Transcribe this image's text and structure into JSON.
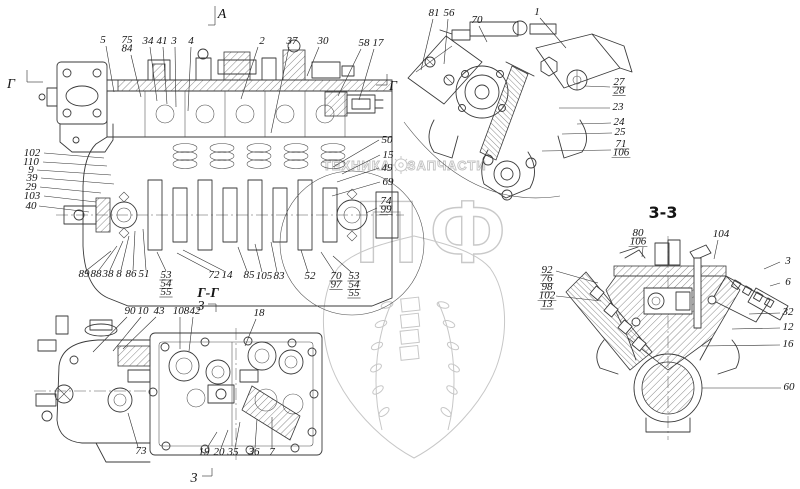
{
  "watermark": {
    "left_text": "ТЕХНИКА",
    "right_text": "ЗАПЧАСТИ",
    "big_text": "ПФ"
  },
  "markers": [
    {
      "t": "A",
      "x": 222,
      "y": 18,
      "cls": "marker",
      "lines": [
        [
          215,
          6,
          215,
          25
        ],
        [
          208,
          25,
          215,
          25
        ]
      ]
    },
    {
      "t": "Г",
      "x": 11,
      "y": 88,
      "cls": "marker",
      "lines": [
        [
          27,
          70,
          27,
          82
        ],
        [
          27,
          82,
          43,
          82
        ]
      ]
    },
    {
      "t": "Г",
      "x": 393,
      "y": 90,
      "cls": "marker",
      "lines": [
        [
          376,
          85,
          387,
          85
        ],
        [
          387,
          74,
          387,
          85
        ]
      ]
    },
    {
      "t": "Г-Г",
      "x": 208,
      "y": 297,
      "cls": "title",
      "lines": []
    },
    {
      "t": "3",
      "x": 201,
      "y": 310,
      "cls": "marker",
      "lines": [
        [
          208,
          304,
          216,
          304
        ],
        [
          216,
          304,
          216,
          312
        ]
      ]
    },
    {
      "t": "3",
      "x": 194,
      "y": 482,
      "cls": "marker",
      "lines": [
        [
          202,
          476,
          212,
          476
        ],
        [
          212,
          468,
          212,
          476
        ]
      ]
    },
    {
      "t": "3-3",
      "x": 663,
      "y": 218,
      "cls": "title2",
      "lines": []
    }
  ],
  "views": [
    {
      "name": "main-longitudinal-section",
      "callouts": [
        {
          "t": [
            "5"
          ],
          "x": 103,
          "y": 43,
          "l": [
            [
              106,
              46,
              114,
              92
            ]
          ]
        },
        {
          "t": [
            "75",
            "84"
          ],
          "x": 127,
          "y": 43,
          "l": [
            [
              131,
              55,
              141,
              97
            ]
          ]
        },
        {
          "t": [
            "34"
          ],
          "x": 148,
          "y": 44,
          "l": [
            [
              150,
              47,
              157,
              101
            ]
          ]
        },
        {
          "t": [
            "41"
          ],
          "x": 162,
          "y": 44,
          "l": [
            [
              163,
              47,
              167,
              104
            ]
          ]
        },
        {
          "t": [
            "3"
          ],
          "x": 174,
          "y": 44,
          "l": [
            [
              175,
              47,
              176,
              107
            ]
          ]
        },
        {
          "t": [
            "4"
          ],
          "x": 191,
          "y": 44,
          "l": [
            [
              191,
              47,
              188,
              111
            ]
          ]
        },
        {
          "t": [
            "2"
          ],
          "x": 262,
          "y": 44,
          "l": [
            [
              258,
              47,
              241,
              99
            ]
          ]
        },
        {
          "t": [
            "37"
          ],
          "x": 292,
          "y": 44,
          "l": [
            [
              289,
              47,
              271,
              133
            ]
          ]
        },
        {
          "t": [
            "30"
          ],
          "x": 323,
          "y": 44,
          "l": [
            [
              319,
              47,
              307,
              76
            ]
          ]
        },
        {
          "t": [
            "58"
          ],
          "x": 364,
          "y": 46,
          "l": [
            [
              361,
              49,
              338,
              96
            ]
          ]
        },
        {
          "t": [
            "17"
          ],
          "x": 378,
          "y": 46,
          "l": [
            [
              374,
              49,
              359,
              100
            ]
          ]
        },
        {
          "t": [
            "102"
          ],
          "x": 32,
          "y": 156,
          "l": [
            [
              44,
              153,
              104,
              158
            ]
          ]
        },
        {
          "t": [
            "110"
          ],
          "x": 31,
          "y": 165,
          "l": [
            [
              43,
              162,
              107,
              166
            ]
          ]
        },
        {
          "t": [
            "9"
          ],
          "x": 31,
          "y": 173,
          "l": [
            [
              37,
              170,
              111,
              175
            ]
          ]
        },
        {
          "t": [
            "39"
          ],
          "x": 32,
          "y": 181,
          "l": [
            [
              41,
              178,
              114,
              184
            ]
          ]
        },
        {
          "t": [
            "29"
          ],
          "x": 31,
          "y": 190,
          "l": [
            [
              40,
              187,
              101,
              193
            ]
          ]
        },
        {
          "t": [
            "103"
          ],
          "x": 32,
          "y": 199,
          "l": [
            [
              44,
              196,
              96,
              202
            ]
          ]
        },
        {
          "t": [
            "40"
          ],
          "x": 31,
          "y": 209,
          "l": [
            [
              39,
              206,
              89,
              212
            ]
          ]
        },
        {
          "t": [
            "50"
          ],
          "x": 387,
          "y": 143,
          "l": [
            [
              379,
              140,
              333,
              167
            ]
          ]
        },
        {
          "t": [
            "15"
          ],
          "x": 388,
          "y": 158,
          "l": [
            [
              380,
              155,
              342,
              174
            ]
          ]
        },
        {
          "t": [
            "49"
          ],
          "x": 387,
          "y": 171,
          "l": [
            [
              379,
              168,
              337,
              182
            ]
          ]
        },
        {
          "t": [
            "69"
          ],
          "x": 388,
          "y": 185,
          "l": [
            [
              380,
              182,
              332,
              196
            ]
          ]
        },
        {
          "t": [
            "74",
            "99"
          ],
          "x": 386,
          "y": 204,
          "u": 1,
          "l": [
            [
              377,
              208,
              366,
              213
            ]
          ]
        },
        {
          "t": [
            "89"
          ],
          "x": 84,
          "y": 277,
          "l": [
            [
              87,
              270,
              111,
              251
            ]
          ]
        },
        {
          "t": [
            "88"
          ],
          "x": 96,
          "y": 277,
          "l": [
            [
              99,
              270,
              117,
              246
            ]
          ]
        },
        {
          "t": [
            "38"
          ],
          "x": 108,
          "y": 277,
          "l": [
            [
              110,
              270,
              123,
              241
            ]
          ]
        },
        {
          "t": [
            "8"
          ],
          "x": 119,
          "y": 277,
          "l": [
            [
              121,
              270,
              129,
              236
            ]
          ]
        },
        {
          "t": [
            "86"
          ],
          "x": 131,
          "y": 277,
          "l": [
            [
              133,
              270,
              135,
              231
            ]
          ]
        },
        {
          "t": [
            "51"
          ],
          "x": 144,
          "y": 277,
          "l": [
            [
              146,
              270,
              143,
              229
            ]
          ]
        },
        {
          "t": [
            "53",
            "54",
            "55"
          ],
          "x": 166,
          "y": 278,
          "u": 1,
          "l": [
            [
              166,
              271,
              157,
              252
            ]
          ]
        },
        {
          "t": [
            "72"
          ],
          "x": 214,
          "y": 278,
          "l": [
            [
              211,
              271,
              177,
              253
            ]
          ]
        },
        {
          "t": [
            "14"
          ],
          "x": 227,
          "y": 278,
          "l": [
            [
              224,
              271,
              183,
              250
            ]
          ]
        },
        {
          "t": [
            "85"
          ],
          "x": 249,
          "y": 278,
          "l": [
            [
              247,
              271,
              238,
              247
            ]
          ]
        },
        {
          "t": [
            "105"
          ],
          "x": 264,
          "y": 279,
          "l": [
            [
              262,
              272,
              255,
              244
            ]
          ]
        },
        {
          "t": [
            "83"
          ],
          "x": 279,
          "y": 279,
          "l": [
            [
              277,
              272,
              271,
              242
            ]
          ]
        },
        {
          "t": [
            "52"
          ],
          "x": 310,
          "y": 279,
          "l": [
            [
              308,
              272,
              301,
              250
            ]
          ]
        },
        {
          "t": [
            "70",
            "97"
          ],
          "x": 336,
          "y": 279,
          "u": 1,
          "l": [
            [
              334,
              272,
              321,
              252
            ]
          ]
        },
        {
          "t": [
            "53",
            "54",
            "55"
          ],
          "x": 354,
          "y": 279,
          "u": 1,
          "l": [
            [
              351,
              272,
              333,
              256
            ]
          ]
        }
      ]
    },
    {
      "name": "front-view",
      "callouts": [
        {
          "t": [
            "81"
          ],
          "x": 434,
          "y": 16,
          "l": [
            [
              433,
              19,
              421,
              70
            ]
          ]
        },
        {
          "t": [
            "56"
          ],
          "x": 449,
          "y": 16,
          "l": [
            [
              448,
              19,
              444,
              64
            ]
          ]
        },
        {
          "t": [
            "70"
          ],
          "x": 477,
          "y": 23,
          "l": [
            [
              479,
              26,
              487,
              42
            ]
          ]
        },
        {
          "t": [
            "1"
          ],
          "x": 537,
          "y": 15,
          "l": [
            [
              540,
              18,
              566,
              48
            ]
          ]
        },
        {
          "t": [
            "27",
            "28"
          ],
          "x": 619,
          "y": 85,
          "u": 1,
          "l": [
            [
              610,
              87,
              585,
              86
            ]
          ]
        },
        {
          "t": [
            "23"
          ],
          "x": 618,
          "y": 110,
          "l": [
            [
              610,
              108,
              559,
              108
            ]
          ]
        },
        {
          "t": [
            "24"
          ],
          "x": 619,
          "y": 125,
          "l": [
            [
              611,
              123,
              577,
              124
            ]
          ]
        },
        {
          "t": [
            "25"
          ],
          "x": 620,
          "y": 135,
          "l": [
            [
              612,
              133,
              562,
              134
            ]
          ]
        },
        {
          "t": [
            "71",
            "106"
          ],
          "x": 621,
          "y": 147,
          "u": 1,
          "l": [
            [
              611,
              150,
              542,
              151
            ]
          ]
        }
      ]
    },
    {
      "name": "section-g-g",
      "callouts": [
        {
          "t": [
            "90"
          ],
          "x": 130,
          "y": 314,
          "l": [
            [
              127,
              317,
              93,
              352
            ]
          ]
        },
        {
          "t": [
            "10"
          ],
          "x": 143,
          "y": 314,
          "l": [
            [
              141,
              317,
              113,
              351
            ]
          ]
        },
        {
          "t": [
            "43"
          ],
          "x": 159,
          "y": 314,
          "l": [
            [
              156,
              317,
              123,
              349
            ]
          ]
        },
        {
          "t": [
            "108"
          ],
          "x": 181,
          "y": 314,
          "l": [
            [
              180,
              317,
              180,
              349
            ]
          ]
        },
        {
          "t": [
            "42"
          ],
          "x": 195,
          "y": 314,
          "l": [
            [
              193,
              317,
              189,
              351
            ]
          ]
        },
        {
          "t": [
            "18"
          ],
          "x": 259,
          "y": 316,
          "l": [
            [
              256,
              319,
              245,
              346
            ]
          ]
        },
        {
          "t": [
            "73"
          ],
          "x": 141,
          "y": 454,
          "l": [
            [
              138,
              447,
              128,
              413
            ]
          ]
        },
        {
          "t": [
            "19"
          ],
          "x": 204,
          "y": 455,
          "l": [
            [
              207,
              448,
              217,
              432
            ]
          ]
        },
        {
          "t": [
            "20"
          ],
          "x": 219,
          "y": 455,
          "l": [
            [
              221,
              448,
              228,
              430
            ]
          ]
        },
        {
          "t": [
            "35"
          ],
          "x": 233,
          "y": 455,
          "l": [
            [
              235,
              448,
              240,
              422
            ]
          ]
        },
        {
          "t": [
            "36"
          ],
          "x": 254,
          "y": 455,
          "l": [
            [
              255,
              448,
              257,
              419
            ]
          ]
        },
        {
          "t": [
            "7"
          ],
          "x": 272,
          "y": 455,
          "l": [
            [
              272,
              448,
              272,
              417
            ]
          ]
        }
      ]
    },
    {
      "name": "section-3-3",
      "callouts": [
        {
          "t": [
            "80",
            "106"
          ],
          "x": 638,
          "y": 236,
          "u": 1,
          "l": [
            [
              643,
              247,
              642,
              257
            ]
          ]
        },
        {
          "t": [
            "104"
          ],
          "x": 721,
          "y": 237,
          "l": [
            [
              718,
              240,
              714,
              259
            ]
          ]
        },
        {
          "t": [
            "3"
          ],
          "x": 788,
          "y": 264,
          "l": [
            [
              780,
              262,
              764,
              269
            ]
          ]
        },
        {
          "t": [
            "6"
          ],
          "x": 788,
          "y": 285,
          "l": [
            [
              780,
              283,
              770,
              286
            ]
          ]
        },
        {
          "t": [
            "32"
          ],
          "x": 788,
          "y": 315,
          "l": [
            [
              780,
              313,
              749,
              314
            ]
          ]
        },
        {
          "t": [
            "12"
          ],
          "x": 788,
          "y": 330,
          "l": [
            [
              780,
              328,
              732,
              329
            ]
          ]
        },
        {
          "t": [
            "16"
          ],
          "x": 788,
          "y": 347,
          "l": [
            [
              780,
              345,
              702,
              346
            ]
          ]
        },
        {
          "t": [
            "60"
          ],
          "x": 789,
          "y": 390,
          "l": [
            [
              781,
              388,
              702,
              388
            ]
          ]
        },
        {
          "t": [
            "92",
            "76",
            "98",
            "102",
            "13"
          ],
          "x": 547,
          "y": 273,
          "u": 1,
          "l": [
            [
              556,
              271,
              598,
              283
            ],
            [
              556,
              296,
              601,
              301
            ]
          ]
        }
      ]
    }
  ]
}
